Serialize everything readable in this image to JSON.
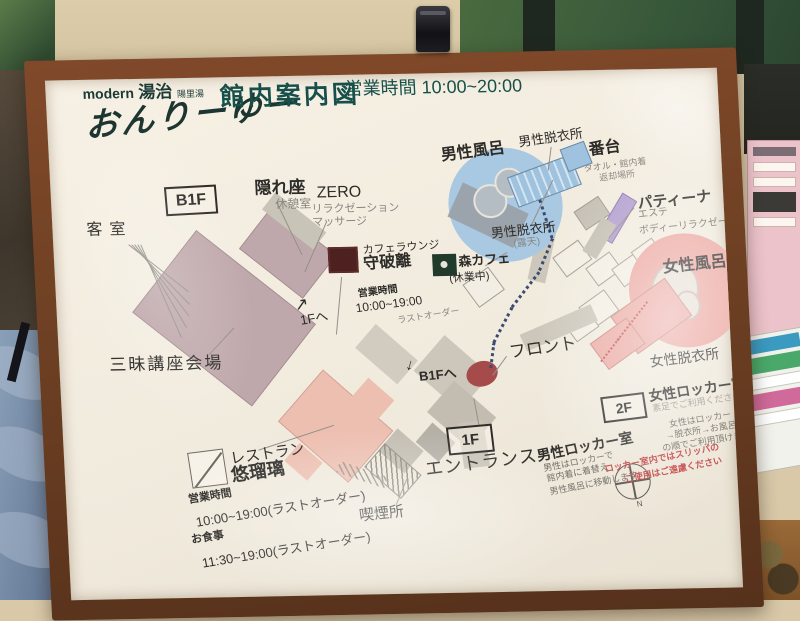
{
  "header": {
    "brand_modern": "modern",
    "brand_touji": "湯治",
    "brand_small": "陽里湯",
    "brand_name": "おんりーゆー",
    "title": "館内案内図",
    "hours_label": "営業時間",
    "hours_value": "10:00~20:00"
  },
  "floors": {
    "b1f": "B1F",
    "f1": "1F",
    "f2": "2F"
  },
  "map": {
    "kakureza": {
      "name": "隠れ座",
      "sub": "休憩室"
    },
    "zero": {
      "name": "ZERO",
      "sub1": "リラクゼーション",
      "sub2": "マッサージ"
    },
    "kyakushitsu": "客室",
    "zanmai": "三昧講座会場",
    "cafe": {
      "type": "カフェラウンジ",
      "name": "守破離",
      "hours_label": "営業時間",
      "hours": "10:00~19:00",
      "last_order": "ラストオーダー"
    },
    "mori_cafe": {
      "name": "森カフェ",
      "status": "(休業中)"
    },
    "mens_bath": "男性風呂",
    "mens_dressing": "男性脱衣所",
    "mens_dressing_open": {
      "name": "男性脱衣所",
      "sub": "(露天)"
    },
    "bandai": {
      "name": "番台",
      "sub1": "タオル・館内着",
      "sub2": "返却場所"
    },
    "patina": {
      "name": "パティーナ",
      "sub1": "エステ",
      "sub2": "ボディーリラクゼーション"
    },
    "womens_bath": "女性風呂",
    "womens_dressing": "女性脱衣所",
    "womens_locker": {
      "name": "女性ロッカー室",
      "note": "素足でご利用ください",
      "line1": "女性はロッカー",
      "line2": "→脱衣所→お風呂",
      "line3": "の順でご利用頂けます"
    },
    "locker_warning": {
      "line1": "ロッカー室内ではスリッパの",
      "line2": "ご使用はご遠慮ください"
    },
    "front": "フロント",
    "to_b1f": {
      "arrow": "↓",
      "label": "B1Fへ"
    },
    "to_1f": {
      "arrow": "↗",
      "label": "1Fへ"
    },
    "entrance": "エントランス",
    "smoking": "喫煙所",
    "mens_locker": {
      "name": "男性ロッカー室",
      "line1": "男性はロッカーで",
      "line2": "館内着に着替え",
      "line3": "男性風呂に移動します"
    },
    "restaurant": {
      "type": "レストラン",
      "name": "悠瑠璃",
      "hours_label": "営業時間",
      "hours": "10:00~19:00(ラストオーダー)",
      "meal_label": "お食事",
      "meal_hours": "11:30~19:00(ラストオーダー)"
    },
    "compass_n": "N"
  },
  "colors": {
    "accent_teal": "#17504a",
    "mens_bath_blue": "#a9c8e1",
    "womens_bath_pink": "#eca69f",
    "patina_purple": "#b3a0cf",
    "front_red": "#a64b4b",
    "warning_red": "#c24444",
    "building_mauve": "#bfa8ab",
    "frame_wood": "#6e4023"
  }
}
